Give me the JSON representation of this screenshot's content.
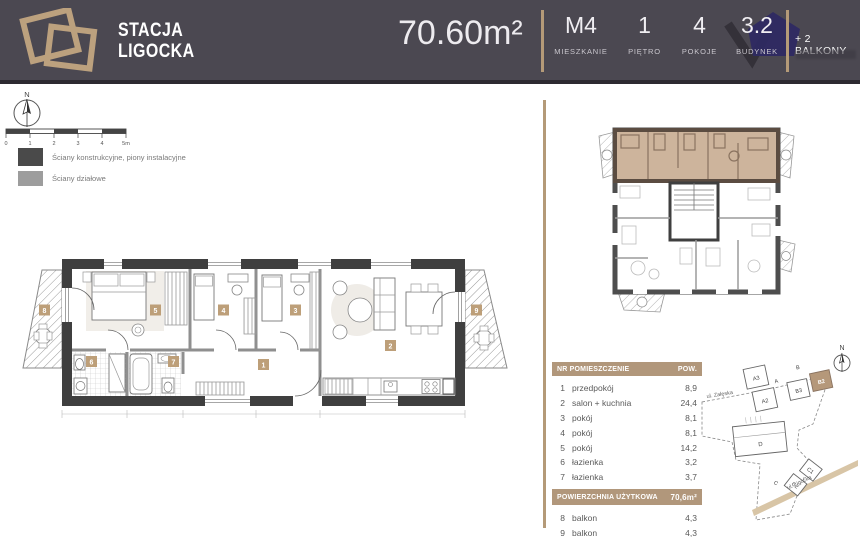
{
  "header": {
    "brand_line1": "STACJA",
    "brand_line2": "LIGOCKA",
    "area": "70.60m²",
    "stats": [
      {
        "value": "M4",
        "label": "MIESZKANIE"
      },
      {
        "value": "1",
        "label": "PIĘTRO"
      },
      {
        "value": "4",
        "label": "POKOJE"
      },
      {
        "value": "3.2",
        "label": "BUDYNEK"
      }
    ],
    "balconies_note": "+ 2 BALKONY"
  },
  "colors": {
    "accent": "#B49A78",
    "header_bg": "#4B4851",
    "highlight_fill": "#CDB49C",
    "wall_dark": "#3F3F3F",
    "partition_gray": "#8F8F8F"
  },
  "compass": {
    "label": "N"
  },
  "scalebar": {
    "ticks": [
      "0",
      "1",
      "2",
      "3",
      "4",
      "5m"
    ]
  },
  "legend": {
    "items": [
      {
        "label": "Ściany konstrukcyjne, piony instalacyjne"
      },
      {
        "label": "Ściany działowe"
      }
    ]
  },
  "plan": {
    "badges": {
      "r1": "1",
      "r2": "2",
      "r3": "3",
      "r4": "4",
      "r5": "5",
      "r6": "6",
      "r7": "7",
      "r8": "8",
      "r9": "9"
    }
  },
  "rooms_table": {
    "header_left": "NR POMIESZCZENIE",
    "header_right": "POW.",
    "rows": [
      {
        "nr": "1",
        "name": "przedpokój",
        "area": "8,9"
      },
      {
        "nr": "2",
        "name": "salon + kuchnia",
        "area": "24,4"
      },
      {
        "nr": "3",
        "name": "pokój",
        "area": "8,1"
      },
      {
        "nr": "4",
        "name": "pokój",
        "area": "8,1"
      },
      {
        "nr": "5",
        "name": "pokój",
        "area": "14,2"
      },
      {
        "nr": "6",
        "name": "łazienka",
        "area": "3,2"
      },
      {
        "nr": "7",
        "name": "łazienka",
        "area": "3,7"
      }
    ],
    "total_label": "POWIERZCHNIA UŻYTKOWA",
    "total_value": "70,6m²",
    "balcony_rows": [
      {
        "nr": "8",
        "name": "balkon",
        "area": "4,3"
      },
      {
        "nr": "9",
        "name": "balkon",
        "area": "4,3"
      }
    ]
  },
  "sitemap": {
    "compass": "N",
    "streets": [
      "ul. Załęska",
      "ul. Ligocka"
    ],
    "buildings": [
      "A3",
      "A",
      "A2",
      "B",
      "B3",
      "B2",
      "D",
      "C1",
      "C2",
      "C"
    ],
    "highlighted_building": "B2"
  }
}
